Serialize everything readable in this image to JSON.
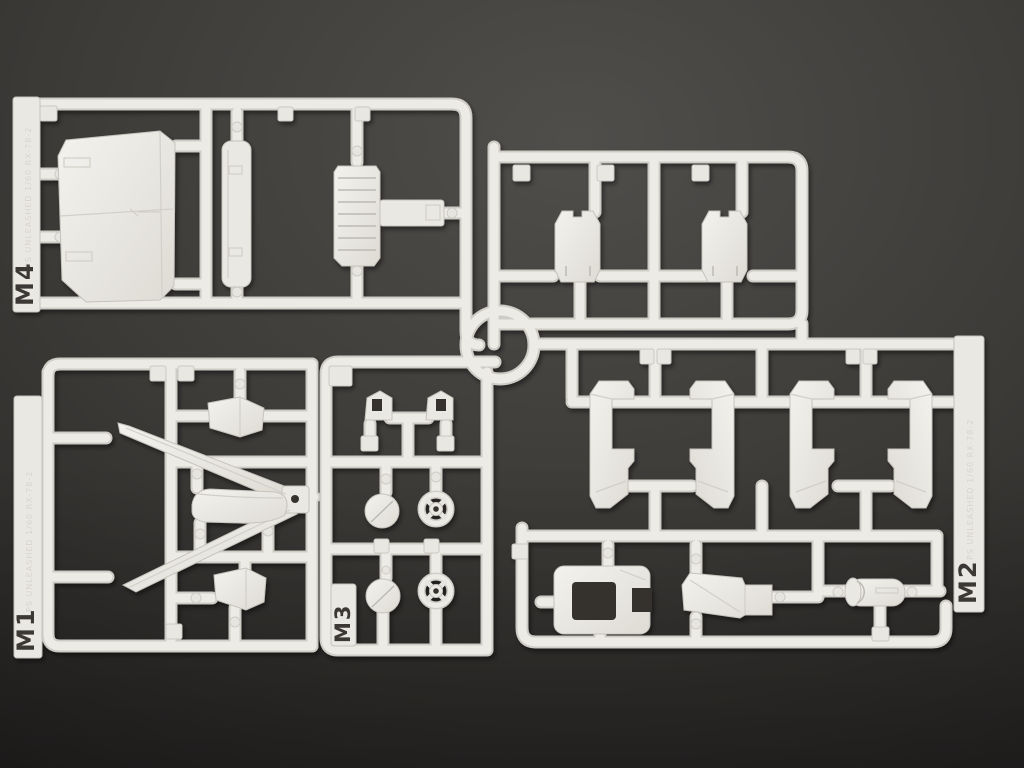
{
  "scene": {
    "type": "photograph",
    "subject": "White injection-molded plastic model-kit sprues (runners M1-M4) laid on a dark gray surface",
    "background_color": "#3f3d3a",
    "plastic_color": "#eceae5",
    "plastic_shadow_color": "#c9c6c0"
  },
  "sprues": [
    {
      "id": "M4",
      "label": "M4",
      "molded_text": "PS UNLEASHED 1/60 RX-78-2",
      "position": "top-left",
      "parts": [
        "backpack-plate",
        "armor-strip",
        "ribbed-vent-plate"
      ]
    },
    {
      "id": "M1",
      "label": "M1",
      "molded_text": "PS UNLEASHED 1/60 RX-78-2",
      "position": "bottom-left",
      "parts": [
        "v-fin-antenna",
        "vent-wedge-upper",
        "curved-armor-cover",
        "vent-wedge-lower"
      ]
    },
    {
      "id": "M3",
      "label": "M3",
      "molded_text": "",
      "position": "bottom-center",
      "parts": [
        "clip-left",
        "clip-right",
        "round-cap-1",
        "spoked-hub-1",
        "round-cap-2",
        "spoked-hub-2"
      ]
    },
    {
      "id": "M2",
      "label": "M2",
      "molded_text": "PS UNLEASHED 1/60 RX-78-2",
      "position": "right",
      "parts": [
        "shin-armor-a",
        "shin-armor-b",
        "shin-armor-c",
        "shin-armor-d",
        "frame-collar",
        "wedge-cover",
        "cylinder-thruster"
      ]
    },
    {
      "id": "top-right-section",
      "label": "",
      "molded_text": "",
      "position": "top-right",
      "parts": [
        "ankle-guard-1",
        "ankle-guard-2"
      ]
    }
  ]
}
